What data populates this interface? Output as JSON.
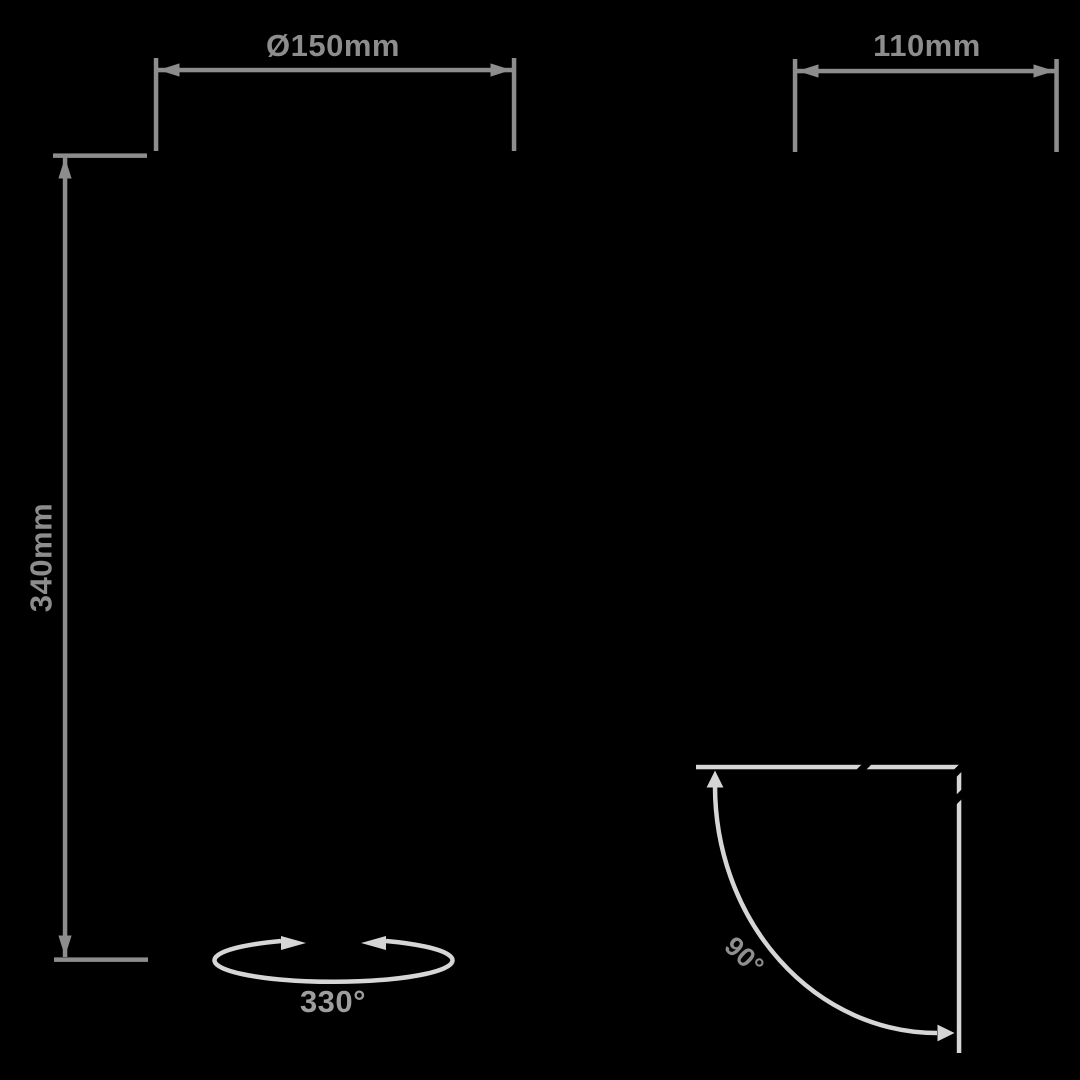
{
  "meta": {
    "description": "Product dimension diagram on black background with gray measurement annotations"
  },
  "colors": {
    "bg": "#000000",
    "dim": "#8d8d8d",
    "arc": "#d6d6d6",
    "rotation-label": "#9e9e9e",
    "tilt-label": "#8f8f8f"
  },
  "dimensions": {
    "diameter": "Ø150mm",
    "width": "110mm",
    "height": "340mm",
    "rotation": "330°",
    "tilt": "90°"
  }
}
